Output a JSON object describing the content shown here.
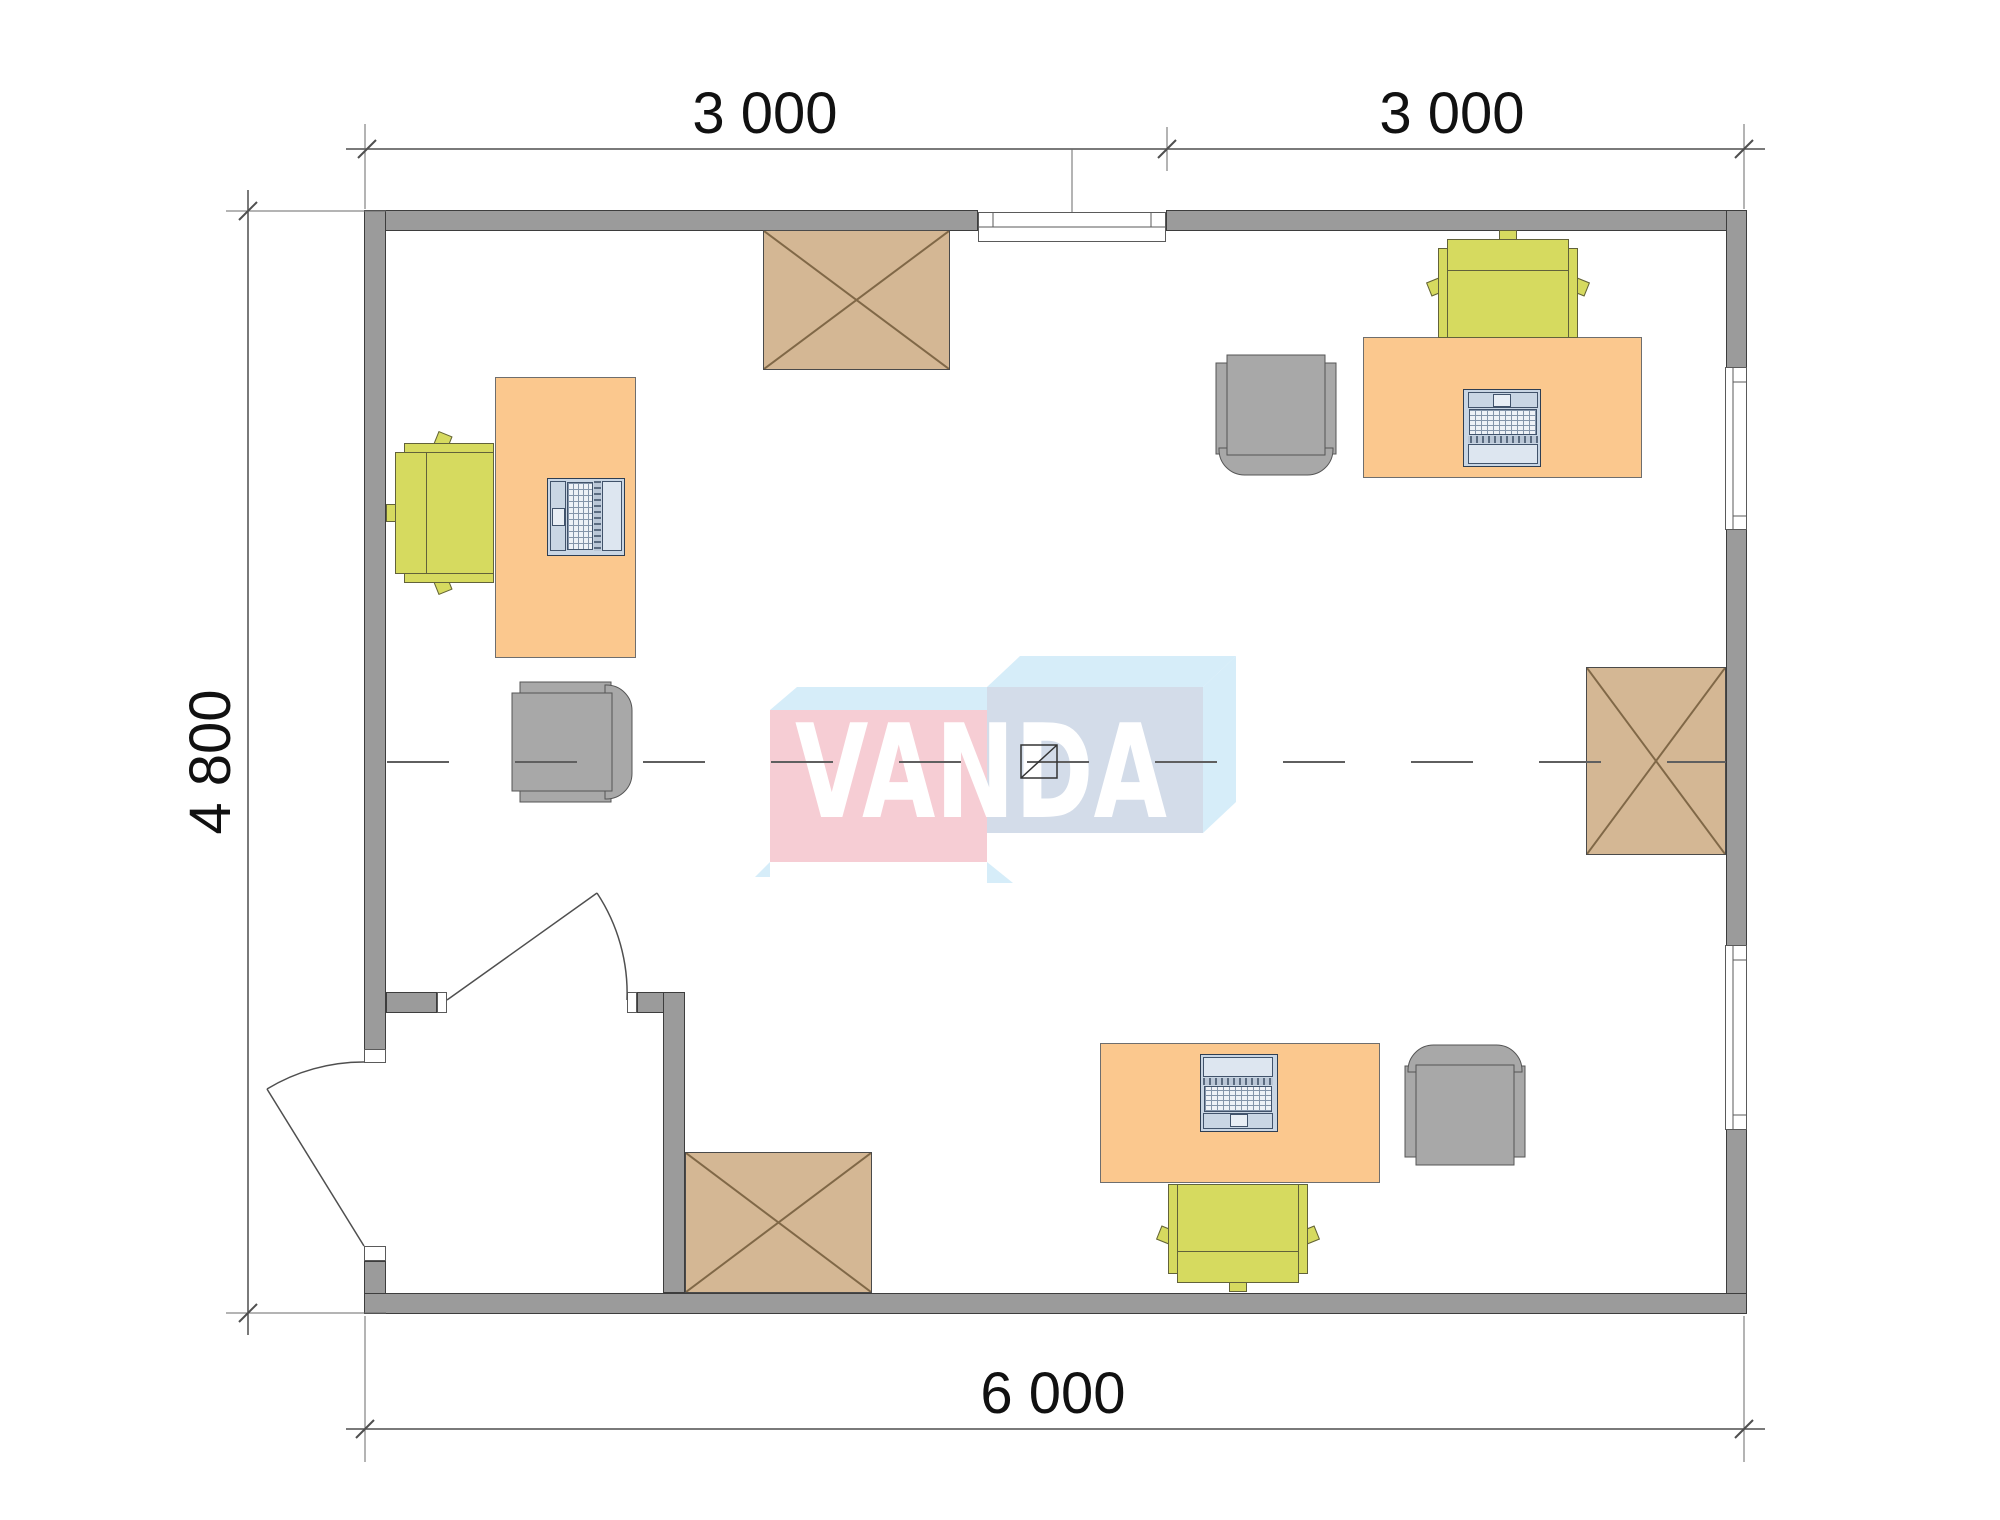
{
  "watermark": {
    "text": "VANDA"
  },
  "dimensions": {
    "top": [
      "3 000",
      "3 000"
    ],
    "left": "4 800",
    "bottom": "6 000"
  },
  "palette": {
    "wall": "#9b9b9b",
    "desk": "#fbc88e",
    "cabinet": "#d4b794",
    "task_chair": "#d6da5f",
    "gray_furniture": "#a8a8a8",
    "laptop": "#c9d6e4",
    "logo_pink": "#f6cdd4",
    "logo_light_blue": "#d6edf9",
    "logo_blue_gray": "#d3dce9"
  },
  "inventory": {
    "desks": 3,
    "task_chairs": 3,
    "armchairs": 3,
    "storage_cabinets": 3,
    "laptops": 3,
    "windows": 3,
    "doors": 2
  }
}
